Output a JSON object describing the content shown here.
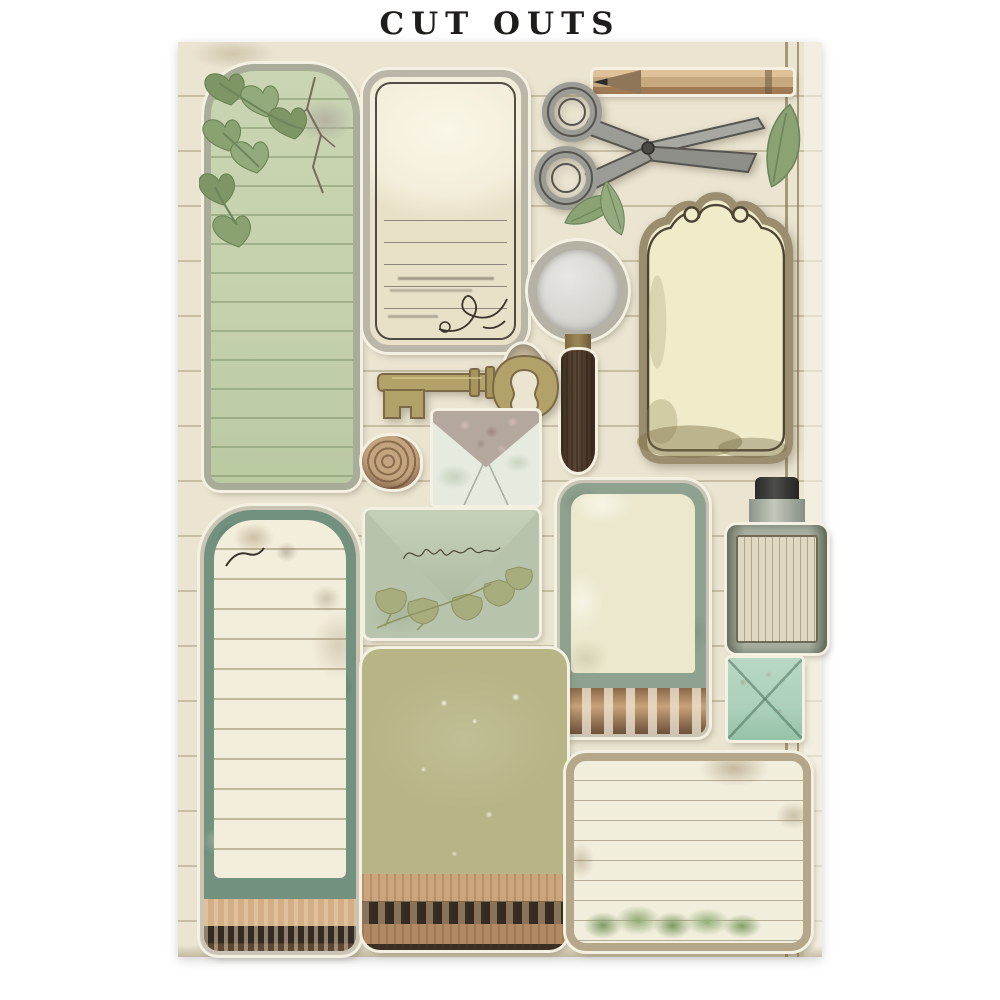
{
  "page": {
    "title": "CUT OUTS"
  },
  "sheet": {
    "description": "Vintage craft cut-outs sheet on ruled aged paper with double margin line at right",
    "style": "aged journal paper, sage green / cream palette"
  },
  "palette": {
    "page-bg": "#ffffff",
    "title-ink": "#1e1d1b",
    "sheet-bg": "#eae4d1",
    "margin-line": "#8f7f55",
    "sticker-edge": "#f4f0e2",
    "ivy-green": "#c4d1ab",
    "ivy-border": "#a9ac99",
    "leaf-green": "#8ba272",
    "cream-paper": "#f3eedb",
    "ink-dark": "#35302a",
    "metal-gray": "#9c9c96",
    "metal-dark": "#5f5e57",
    "wood-pencil": "#c8a87e",
    "wood-handle": "#5a4636",
    "brass": "#9b8756",
    "key-brass": "#b2a169",
    "glass-gray": "#d9d7d2",
    "sage-env": "#b7c3ad",
    "teal-border": "#72927f",
    "sage-border": "#8fa28f",
    "mint-env": "#abd0bb",
    "olive-card": "#b7b586",
    "tan-wood": "#c9a279",
    "dark-band": "#332b21",
    "label-cream": "#ded8c0",
    "bottle-glass": "#aab2a2",
    "note-border": "#b4a78a",
    "liner-mauve": "#b3a79e"
  },
  "items": [
    {
      "name": "ivy-journaling-tag",
      "description": "tall arched green tag with ruled lines, ivy leaves and torn plaster patch"
    },
    {
      "name": "cream-ornate-tag",
      "description": "cream tag with black ink frame, writing lines and corner flourish"
    },
    {
      "name": "pencil",
      "description": "short wooden pencil, graphite tip pointing left"
    },
    {
      "name": "vintage-scissors",
      "description": "old grey metal scissors, blades open toward the right"
    },
    {
      "name": "green-leaf",
      "description": "single sage green leaf (three on sheet)"
    },
    {
      "name": "ornate-label",
      "description": "cream scalloped-top label with scroll curls and grunge bottom"
    },
    {
      "name": "magnifying-glass",
      "description": "round magnifier with silver rim, brass collar and dark wooden handle"
    },
    {
      "name": "mother-of-pearl-buckle",
      "description": "small oval ring buckle"
    },
    {
      "name": "skeleton-key",
      "description": "brass vintage key, bow at right, bit at left"
    },
    {
      "name": "snail-shell",
      "description": "spiral tan snail shell"
    },
    {
      "name": "open-envelope",
      "description": "small open envelope showing rose-patterned liner"
    },
    {
      "name": "teal-tall-tag",
      "description": "tall arched tag, mottled teal border, lined cream paper, ink splats, wooden base"
    },
    {
      "name": "sage-envelope",
      "description": "sage green closed envelope with handwritten script and ginkgo leaves"
    },
    {
      "name": "sage-tag",
      "description": "green-framed tag with torn cream paper and wooden base strip"
    },
    {
      "name": "apothecary-bottle",
      "description": "grey glass bottle, dark cap, aged label with vertical script"
    },
    {
      "name": "mint-envelope",
      "description": "small mint square envelope seen from the back"
    },
    {
      "name": "olive-speckled-card",
      "description": "olive green textured card with carved wooden molding base"
    },
    {
      "name": "lined-note-card",
      "description": "horizontal ruled note card with tan frame and green foliage at bottom"
    }
  ]
}
